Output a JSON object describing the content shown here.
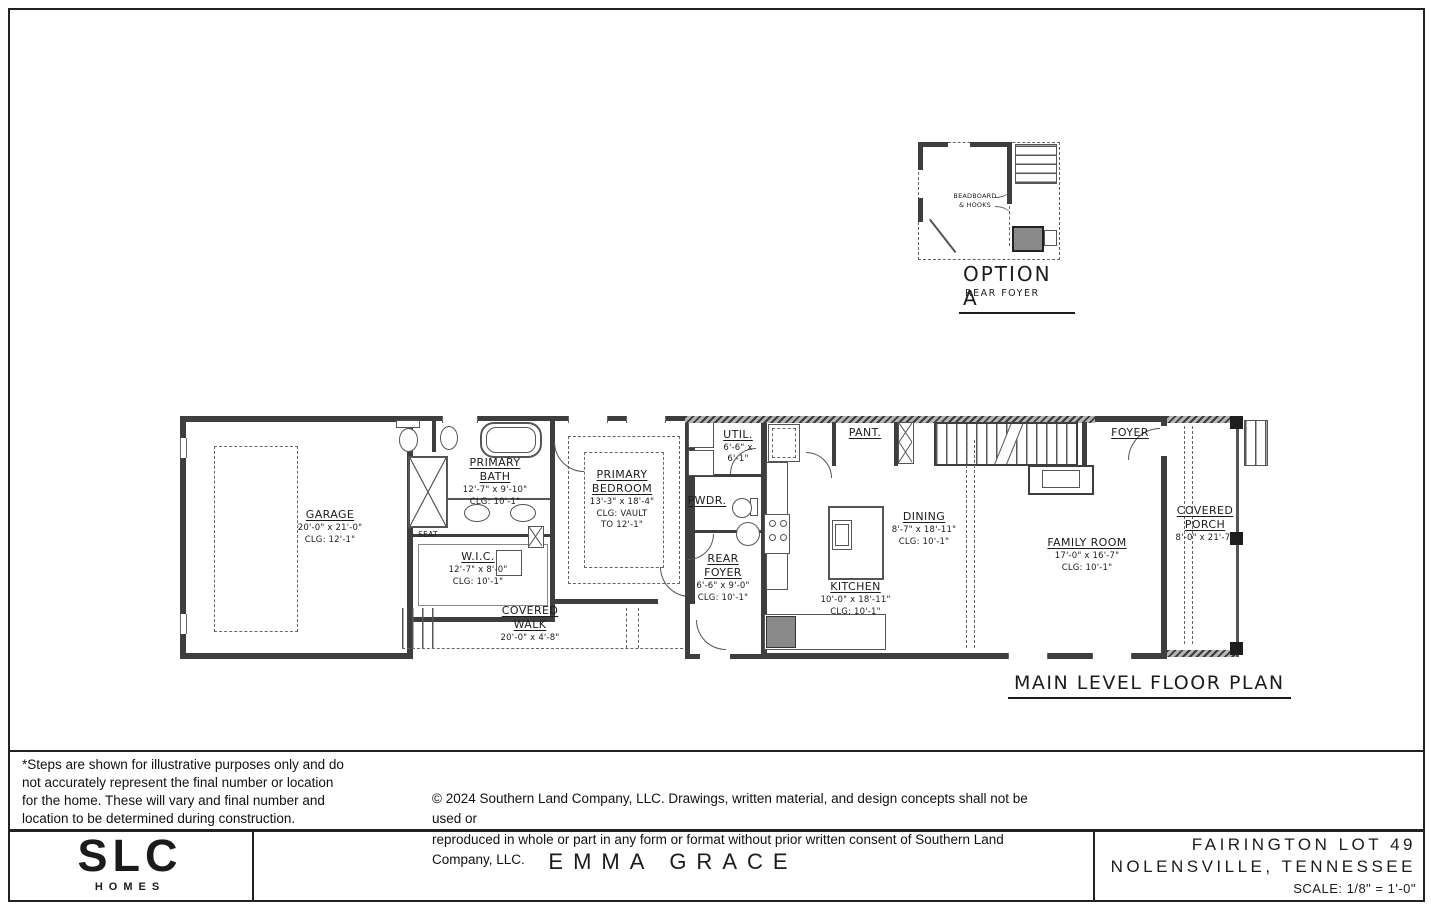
{
  "option": {
    "annotation": "BEADBOARD\n& HOOKS",
    "title": "OPTION A",
    "subtitle": "REAR FOYER"
  },
  "plan": {
    "title": "MAIN LEVEL FLOOR PLAN",
    "labels": {
      "seat": "SEAT"
    },
    "rooms": {
      "garage": {
        "name": "GARAGE",
        "dims": "20'-0\" x 21'-0\"",
        "clg": "CLG:  12'-1\""
      },
      "primary_bath": {
        "name": "PRIMARY\nBATH",
        "dims": "12'-7\" x 9'-10\"",
        "clg": "CLG:  10'-1\""
      },
      "wic": {
        "name": "W.I.C.",
        "dims": "12'-7\" x 8'-0\"",
        "clg": "CLG:  10'-1\""
      },
      "primary_bedroom": {
        "name": "PRIMARY\nBEDROOM",
        "dims": "13'-3\" x 18'-4\"",
        "clg": "CLG: VAULT\nTO 12'-1\""
      },
      "covered_walk": {
        "name": "COVERED\nWALK",
        "dims": "20'-0\" x 4'-8\""
      },
      "rear_foyer": {
        "name": "REAR\nFOYER",
        "dims": "6'-6\" x 9'-0\"",
        "clg": "CLG: 10'-1\""
      },
      "pwdr": {
        "name": "PWDR."
      },
      "util": {
        "name": "UTIL.",
        "dims": "6'-6\" x\n6'-1\""
      },
      "pant": {
        "name": "PANT."
      },
      "kitchen": {
        "name": "KITCHEN",
        "dims": "10'-0\" x 18'-11\"",
        "clg": "CLG:  10'-1\""
      },
      "dining": {
        "name": "DINING",
        "dims": "8'-7\" x 18'-11\"",
        "clg": "CLG:  10'-1\""
      },
      "family_room": {
        "name": "FAMILY ROOM",
        "dims": "17'-0\" x 16'-7\"",
        "clg": "CLG:  10'-1\""
      },
      "foyer": {
        "name": "FOYER"
      },
      "covered_porch": {
        "name": "COVERED\nPORCH",
        "dims": "8'-0\" x 21'-7\""
      }
    }
  },
  "notes": {
    "steps_disclaimer": "*Steps are shown for illustrative purposes only and do\nnot accurately represent the final number or location\nfor the home.  These will vary and final number and\nlocation to be determined during construction.",
    "copyright": "© 2024 Southern Land Company, LLC. Drawings, written material, and design concepts shall not be used or\nreproduced in whole or part in any form or format without prior written consent of Southern Land Company, LLC."
  },
  "title_block": {
    "brand": "SLC",
    "brand_sub": "HOMES",
    "plan_name": "EMMA GRACE",
    "project_line1": "FAIRINGTON LOT 49",
    "project_line2": "NOLENSVILLE, TENNESSEE",
    "scale": "SCALE: 1/8\" = 1'-0\""
  },
  "colors": {
    "line": "#3e3e3e",
    "accent": "#555555",
    "paper": "#ffffff"
  }
}
